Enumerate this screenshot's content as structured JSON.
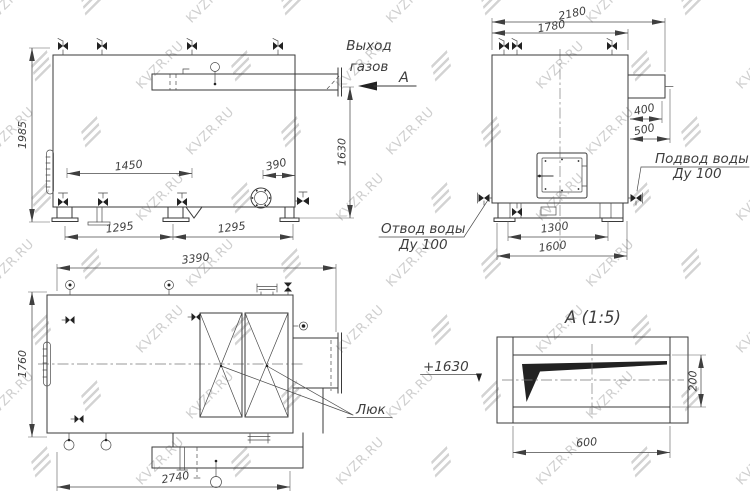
{
  "watermark": {
    "text": "KVZR.RU",
    "color": "#c7c7c7"
  },
  "palette": {
    "line": "#3a3a3a",
    "dim_text": "#3f3f3f",
    "background": "#ffffff"
  },
  "side_view": {
    "gas_outlet_label": {
      "line1": "Выход",
      "line2": "газов"
    },
    "section_arrow": "А",
    "dim_overall_height": "1985",
    "dim_outlet_height": "1630",
    "dim_top_span": "1450",
    "dim_burner_to_wall": "390",
    "dim_leg_span_1": "1295",
    "dim_leg_span_2": "1295"
  },
  "front_view": {
    "dim_overall_width": "2180",
    "dim_body_width": "1780",
    "dim_flue_length": "400",
    "dim_flue_overall": "500",
    "dim_leg_span": "1300",
    "dim_base_width": "1600",
    "water_inlet_label": {
      "line1": "Подвод воды",
      "line2": "Ду 100"
    },
    "water_outlet_label": {
      "line1": "Отвод воды",
      "line2": "Ду 100"
    }
  },
  "top_view": {
    "dim_overall_length": "3390",
    "dim_overall_width": "1760",
    "dim_base_length": "2740",
    "hatch_label": "Люк"
  },
  "detail_view": {
    "title": "А (1:5)",
    "elevation_mark": "+1630",
    "dim_length": "600",
    "dim_height": "200"
  }
}
